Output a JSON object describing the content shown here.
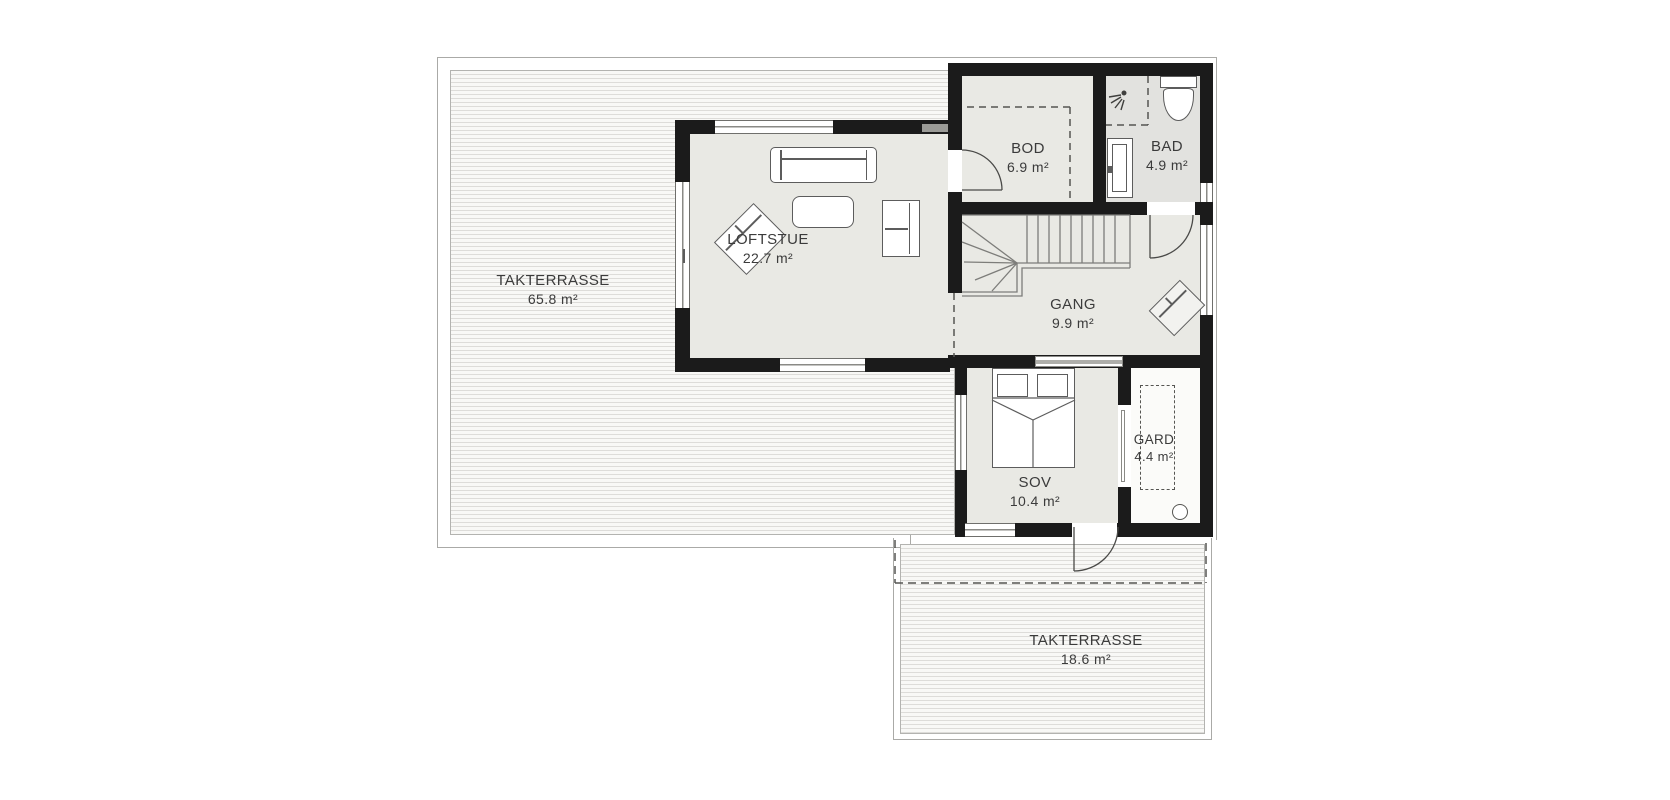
{
  "rooms": [
    {
      "id": "takterrasse-large",
      "name": "TAKTERRASSE",
      "area": "65.8 m²"
    },
    {
      "id": "loftstue",
      "name": "LOFTSTUE",
      "area": "22.7 m²"
    },
    {
      "id": "bod",
      "name": "BOD",
      "area": "6.9 m²"
    },
    {
      "id": "bad",
      "name": "BAD",
      "area": "4.9 m²"
    },
    {
      "id": "gang",
      "name": "GANG",
      "area": "9.9 m²"
    },
    {
      "id": "sov",
      "name": "SOV",
      "area": "10.4 m²"
    },
    {
      "id": "gard",
      "name": "GARD",
      "area": "4.4 m²"
    },
    {
      "id": "takterrasse-small",
      "name": "TAKTERRASSE",
      "area": "18.6 m²"
    }
  ],
  "furniture_icons": {
    "loftstue": [
      "sofa",
      "coffee-table",
      "armchair",
      "lounge-chair-diagonal"
    ],
    "gang": [
      "staircase",
      "lounge-chair-diagonal"
    ],
    "sov": [
      "double-bed"
    ],
    "bad": [
      "toilet",
      "sink-vanity",
      "shower-head"
    ],
    "gard": [
      "wardrobe-dashed-outline",
      "ceiling-point"
    ]
  },
  "colors": {
    "wall": "#1b1b1b",
    "room_floor": "#e9e9e4",
    "bath_floor": "#e2e2df",
    "deck_stripe": "#dddcd9",
    "deck_background": "#f8f8f6",
    "furniture_outline": "#5c5c5c",
    "text": "#3b3b3b"
  }
}
